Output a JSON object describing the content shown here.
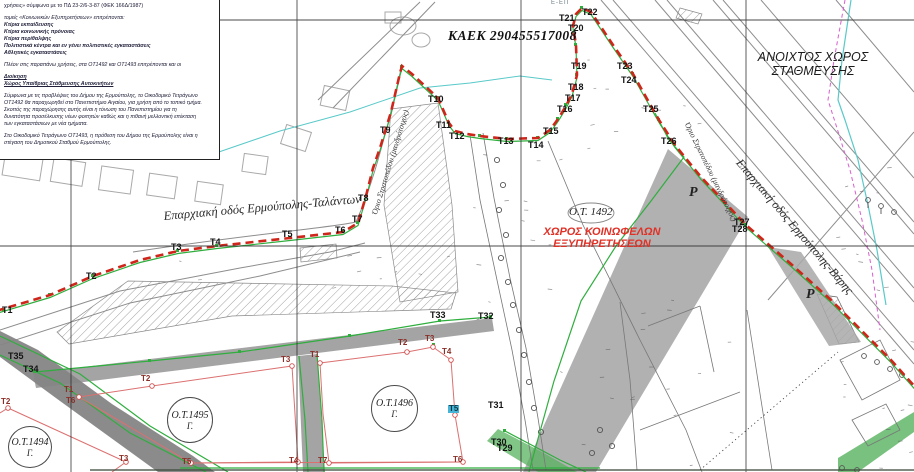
{
  "legend": {
    "line1": "χρήσεις» σύμφωνα με το ΠΔ 23-2/6-3-87 (ΦΕΚ 166Δ/1987)",
    "line2": "τομείς «Κοινωνικών Εξυπηρετήσεων» επιτρέπονται:",
    "uses": [
      "Κτίρια εκπαίδευσης",
      "Κτίρια κοινωνικής πρόνοιας",
      "Κτίρια περίθαλψης",
      "Πολιτιστικά κέντρα και εν γένει πολιτιστικές εγκαταστάσεις",
      "Αθλητικές εγκαταστάσεις"
    ],
    "note": "Πλέον στις παραπάνω χρήσεις, στα ΟΤ1492 και ΟΤ1493 επιτρέπονται και οι",
    "heading_admin": "Διοίκηση",
    "heading_parking": "Χώρος Υπαίθριας Στάθμευσης Αυτοκινήτων",
    "para1_lines": [
      "Σύμφωνα με τις προβλέψεις του Δήμου της Ερμούπολης, το Οικοδομικό Τετράγωνο",
      "ΟΤ1492 θα παραχωρηθεί στο Πανεπιστήμιο Αιγαίου, για χρήση από το τοπικό τμήμα.",
      "Σκοπός της παραχώρησης αυτής είναι η τόνωση του Πανεπιστημίου για τη",
      "δυνατότητα προσέλκυσης νέων φοιτητών καθώς και η πιθανή μελλοντική επέκταση",
      "των εγκαταστάσεων με νέα τμήματα."
    ],
    "para2_lines": [
      "Στο Οικοδομικό Τετράγωνο ΟΤ1493, η πρόθεση του Δήμου της Ερμούπολης είναι η",
      "στέγαση του Δημοτικού Σταθμού Ερμούπολης."
    ]
  },
  "map": {
    "kaek_label": "ΚΑΕΚ 290455517008",
    "e_ep_label": "Ε-ΕΠ",
    "open_parking_line1": "ΑΝΟΙΧΤΟΣ ΧΩΡΟΣ",
    "open_parking_line2": "ΣΤΑΘΜΕΥΣΗΣ",
    "block_1492": {
      "id": "Ο.Τ. 1492",
      "use_line1": "ΧΩΡΟΣ ΚΟΙΝΩΦΕΛΩΝ",
      "use_line2": "ΕΞΥΠΗΡΕΤΗΣΕΩΝ"
    },
    "roads": {
      "talanton": "Επαρχιακή οδός Ερμούπολης-Ταλάντων",
      "varis": "Επαρχιακή οδός Ερμούπολης-Βάρης"
    },
    "camp_wall_1": "Όριο Στρατοπέδου (μανδρότοιχος)",
    "camp_wall_2": "Όριο Στρατοπέδου (μανδρότοιχος)",
    "parking_p_1": "Ρ",
    "parking_p_2": "Ρ",
    "blocks": [
      {
        "id": "Ο.Τ.1494",
        "sub": "Γ."
      },
      {
        "id": "Ο.Τ.1495",
        "sub": "Γ."
      },
      {
        "id": "Ο.Τ.1496",
        "sub": "Γ."
      }
    ],
    "points": [
      {
        "id": "Τ1",
        "x": 2,
        "y": 306,
        "kind": "b"
      },
      {
        "id": "Τ2",
        "x": 86,
        "y": 272,
        "kind": "b"
      },
      {
        "id": "Τ3",
        "x": 171,
        "y": 243,
        "kind": "b"
      },
      {
        "id": "Τ4",
        "x": 210,
        "y": 238,
        "kind": "b"
      },
      {
        "id": "Τ5",
        "x": 282,
        "y": 230,
        "kind": "b"
      },
      {
        "id": "Τ6",
        "x": 335,
        "y": 226,
        "kind": "b"
      },
      {
        "id": "Τ7",
        "x": 352,
        "y": 215,
        "kind": "b"
      },
      {
        "id": "Τ8",
        "x": 358,
        "y": 194,
        "kind": "b"
      },
      {
        "id": "Τ9",
        "x": 380,
        "y": 126,
        "kind": "b"
      },
      {
        "id": "Τ10",
        "x": 428,
        "y": 95,
        "kind": "b"
      },
      {
        "id": "Τ11",
        "x": 436,
        "y": 121,
        "kind": "b"
      },
      {
        "id": "Τ12",
        "x": 449,
        "y": 132,
        "kind": "b"
      },
      {
        "id": "Τ13",
        "x": 498,
        "y": 137,
        "kind": "b"
      },
      {
        "id": "Τ14",
        "x": 528,
        "y": 141,
        "kind": "b"
      },
      {
        "id": "Τ15",
        "x": 543,
        "y": 127,
        "kind": "b"
      },
      {
        "id": "Τ16",
        "x": 557,
        "y": 105,
        "kind": "b"
      },
      {
        "id": "Τ17",
        "x": 565,
        "y": 94,
        "kind": "b"
      },
      {
        "id": "Τ18",
        "x": 568,
        "y": 83,
        "kind": "b"
      },
      {
        "id": "Τ19",
        "x": 571,
        "y": 62,
        "kind": "b"
      },
      {
        "id": "Τ20",
        "x": 568,
        "y": 24,
        "kind": "b"
      },
      {
        "id": "Τ21",
        "x": 559,
        "y": 14,
        "kind": "b"
      },
      {
        "id": "Τ22",
        "x": 582,
        "y": 8,
        "kind": "b"
      },
      {
        "id": "Τ23",
        "x": 617,
        "y": 62,
        "kind": "b"
      },
      {
        "id": "Τ24",
        "x": 621,
        "y": 76,
        "kind": "b"
      },
      {
        "id": "Τ25",
        "x": 643,
        "y": 105,
        "kind": "b"
      },
      {
        "id": "Τ26",
        "x": 661,
        "y": 137,
        "kind": "b"
      },
      {
        "id": "Τ27",
        "x": 734,
        "y": 218,
        "kind": "b"
      },
      {
        "id": "Τ28",
        "x": 732,
        "y": 225,
        "kind": "b"
      },
      {
        "id": "Τ29",
        "x": 497,
        "y": 444,
        "kind": "b"
      },
      {
        "id": "Τ30",
        "x": 491,
        "y": 438,
        "kind": "b"
      },
      {
        "id": "Τ31",
        "x": 488,
        "y": 401,
        "kind": "b"
      },
      {
        "id": "Τ32",
        "x": 478,
        "y": 312,
        "kind": "b"
      },
      {
        "id": "Τ33",
        "x": 430,
        "y": 311,
        "kind": "b"
      },
      {
        "id": "Τ34",
        "x": 23,
        "y": 365,
        "kind": "b"
      },
      {
        "id": "Τ35",
        "x": 8,
        "y": 352,
        "kind": "b"
      },
      {
        "id": "Τ2",
        "x": 1,
        "y": 398,
        "kind": "block"
      },
      {
        "id": "Τ3",
        "x": 119,
        "y": 455,
        "kind": "block"
      },
      {
        "id": "Τ1",
        "x": 64,
        "y": 386,
        "kind": "block"
      },
      {
        "id": "Τ6",
        "x": 66,
        "y": 397,
        "kind": "block"
      },
      {
        "id": "Τ2",
        "x": 141,
        "y": 375,
        "kind": "block"
      },
      {
        "id": "Τ3",
        "x": 281,
        "y": 356,
        "kind": "block"
      },
      {
        "id": "Τ5",
        "x": 182,
        "y": 458,
        "kind": "block"
      },
      {
        "id": "Τ4",
        "x": 289,
        "y": 457,
        "kind": "block"
      },
      {
        "id": "Τ1",
        "x": 310,
        "y": 351,
        "kind": "block"
      },
      {
        "id": "Τ2",
        "x": 398,
        "y": 339,
        "kind": "block"
      },
      {
        "id": "Τ3",
        "x": 425,
        "y": 335,
        "kind": "block"
      },
      {
        "id": "Τ4",
        "x": 442,
        "y": 348,
        "kind": "block"
      },
      {
        "id": "Τ5",
        "x": 448,
        "y": 405,
        "kind": "block",
        "hl": true
      },
      {
        "id": "Τ6",
        "x": 453,
        "y": 456,
        "kind": "block"
      },
      {
        "id": "Τ7",
        "x": 318,
        "y": 457,
        "kind": "block"
      }
    ]
  },
  "colors": {
    "boundary_red": "#cf261b",
    "survey_green": "#2fae3e",
    "zone_text_red": "#e03127",
    "band_gray": "#a3a3a3",
    "cyan_line": "#59c9c9",
    "magenta_line": "#d95fd0"
  }
}
